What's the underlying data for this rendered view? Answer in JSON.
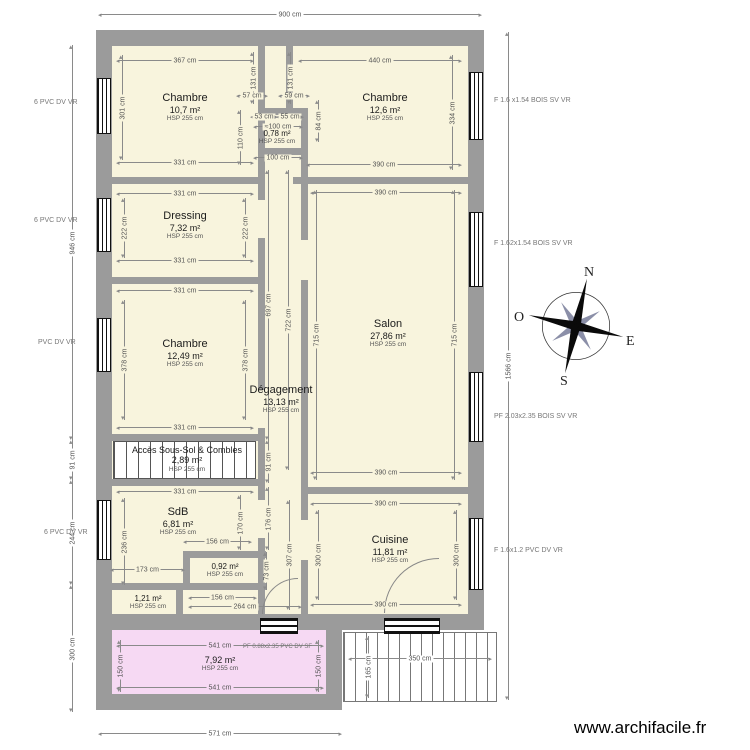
{
  "watermark": "www.archifacile.fr",
  "compass": {
    "n": "N",
    "s": "S",
    "e": "E",
    "o": "O"
  },
  "rooms": [
    {
      "name": "Chambre",
      "area": "10,7 m²",
      "hsp": "HSP 255 cm"
    },
    {
      "name": "Chambre",
      "area": "12,6 m²",
      "hsp": "HSP 255 cm"
    },
    {
      "name": "",
      "area": "0,78 m²",
      "hsp": "HSP 255 cm"
    },
    {
      "name": "Dressing",
      "area": "7,32 m²",
      "hsp": "HSP 255 cm"
    },
    {
      "name": "Chambre",
      "area": "12,49 m²",
      "hsp": "HSP 255 cm"
    },
    {
      "name": "Salon",
      "area": "27,86 m²",
      "hsp": "HSP 255 cm"
    },
    {
      "name": "Dégagement",
      "area": "13,13 m²",
      "hsp": "HSP 255 cm"
    },
    {
      "name": "Accès Sous-Sol & Combles",
      "area": "2,89 m²",
      "hsp": "HSP 255 cm"
    },
    {
      "name": "SdB",
      "area": "6,81 m²",
      "hsp": "HSP 255 cm"
    },
    {
      "name": "",
      "area": "0,92 m²",
      "hsp": "HSP 255 cm"
    },
    {
      "name": "",
      "area": "1,21 m²",
      "hsp": "HSP 255 cm"
    },
    {
      "name": "Cuisine",
      "area": "11,81 m²",
      "hsp": "HSP 255 cm"
    },
    {
      "name": "",
      "area": "7,92 m²",
      "hsp": "HSP 255 cm"
    }
  ],
  "openings": [
    "6 PVC DV VR",
    "6 PVC DV VR",
    "PVC DV VR",
    "6 PVC DV VR",
    "F 1.6 x1.54 BOIS SV VR",
    "F 1.62x1.54 BOIS SV VR",
    "PF 2.03x2.35 BOIS SV VR",
    "F 1.6x1.2 PVC DV VR",
    "PF 0.88x2.35 PVC DV SF"
  ],
  "dims": [
    "900 cm",
    "946 cm",
    "91 cm",
    "244 cm",
    "300 cm",
    "1566 cm",
    "571 cm",
    "367 cm",
    "440 cm",
    "301 cm",
    "334 cm",
    "331 cm",
    "390 cm",
    "131 cm",
    "131 cm",
    "57 cm",
    "59 cm",
    "53 cm",
    "55 cm",
    "≈100 cm",
    "110 cm",
    "84 cm",
    "100 cm",
    "331 cm",
    "222 cm",
    "222 cm",
    "331 cm",
    "331 cm",
    "378 cm",
    "378 cm",
    "331 cm",
    "331 cm",
    "697 cm",
    "722 cm",
    "715 cm",
    "715 cm",
    "390 cm",
    "390 cm",
    "91 cm",
    "176 cm",
    "236 cm",
    "170 cm",
    "156 cm",
    "173 cm",
    "307 cm",
    "73 cm",
    "156 cm",
    "264 cm",
    "390 cm",
    "390 cm",
    "300 cm",
    "300 cm",
    "541 cm",
    "541 cm",
    "150 cm",
    "150 cm",
    "350 cm",
    "165 cm"
  ],
  "colors": {
    "wall": "#9b9b9b",
    "floor": "#f8f4dd",
    "annex_floor": "#f6d9f3",
    "dim_line": "#8a8a8a"
  }
}
